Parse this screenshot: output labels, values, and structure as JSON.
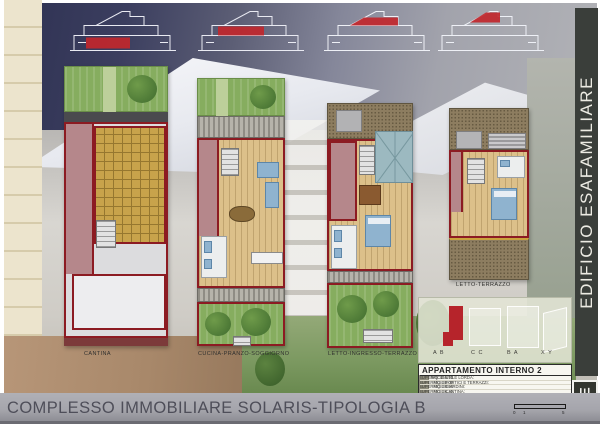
{
  "sheet": {
    "bottom_title": "COMPLESSO IMMOBILIARE SOLARIS-TIPOLOGIA B",
    "side_banner": "EDIFICIO ESAFAMILIARE",
    "logo_glyph": "E"
  },
  "plans": {
    "labels": [
      "CANTINA",
      "CUCINA-PRANZO-SOGGIORNO",
      "LETTO-INGRESSO-TERRAZZO",
      "LETTO-TERRAZZO"
    ]
  },
  "key_plan": {
    "unit_labels": [
      "A B",
      "C C",
      "B A",
      "X Y"
    ]
  },
  "area_table": {
    "title": "APPARTAMENTO INTERNO 2",
    "rows": [
      {
        "label": "SUPERFICIE UTILE LORDA:",
        "value": "MQ. 159.50"
      },
      {
        "label": "SUPERFICIE PORTICI E TERRAZZI:",
        "value": "MQ. 38.00"
      },
      {
        "label": "SUPERFICIE GIARDINI:",
        "value": "MQ. 39.50"
      },
      {
        "label": "SUPERFICIE CANTINA:",
        "value": "MQ. 36.20"
      }
    ]
  },
  "scale_bar": {
    "ticks": [
      "0",
      "1",
      "5"
    ]
  },
  "colors": {
    "section_highlight_red": "#c1272d",
    "plan_wall_red": "#8c1b22",
    "side_banner_bg": "#3a3e3a",
    "bottom_banner_gray": "#a5a5ac",
    "garden_green": "#86ad5f",
    "wood_floor": "#dcc08a",
    "tile_ochre": "#c8a34b",
    "roof_teal": "#9cb9c0",
    "mauve_room": "#b5878b",
    "sky_navy": "#2e3152"
  }
}
